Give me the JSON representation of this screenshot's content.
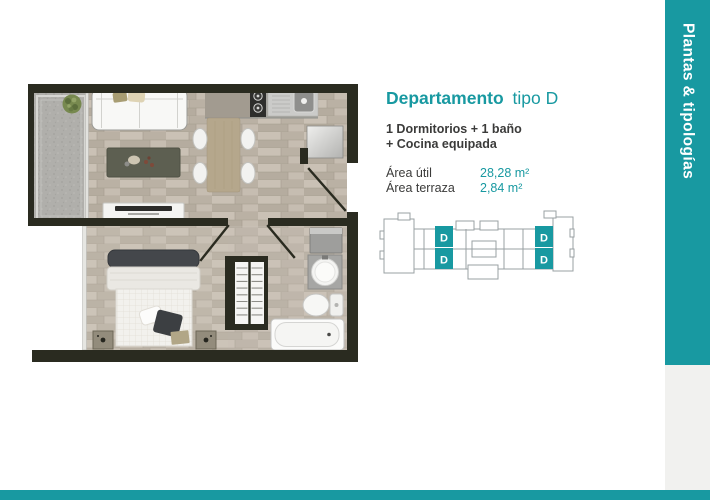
{
  "colors": {
    "teal": "#1899a1",
    "dark_text": "#3b3b3a",
    "wall": "#2a2b20",
    "keyplan_outline": "#9aa0a3"
  },
  "info": {
    "title": "Departamento",
    "title_suffix": "tipo D",
    "subtitle_line1": "1 Dormitorios + 1 baño",
    "subtitle_line2": "+ Cocina equipada",
    "areas": [
      {
        "label": "Área útil",
        "value": "28,28 m²"
      },
      {
        "label": "Área terraza",
        "value": "2,84 m²"
      }
    ]
  },
  "keyplan": {
    "unit_labels": [
      "D",
      "D",
      "D",
      "D"
    ]
  },
  "sidebar": {
    "label": "Plantas & tipologías"
  },
  "floorplan": {
    "icons": [
      "terrace",
      "plant-icon",
      "sofa-icon",
      "coffee-table-icon",
      "tv-console-icon",
      "kitchen-counter",
      "stove-icon",
      "kitchen-sink-icon",
      "dining-table-icon",
      "dining-chair-icon",
      "entry-mirror-closet",
      "entry-door",
      "bedroom-door",
      "bathroom-door",
      "bed-icon",
      "nightstand-icon",
      "wardrobe-rails",
      "laundry-cabinet",
      "bathroom-sink-icon",
      "toilet-icon",
      "bathtub-icon"
    ]
  }
}
